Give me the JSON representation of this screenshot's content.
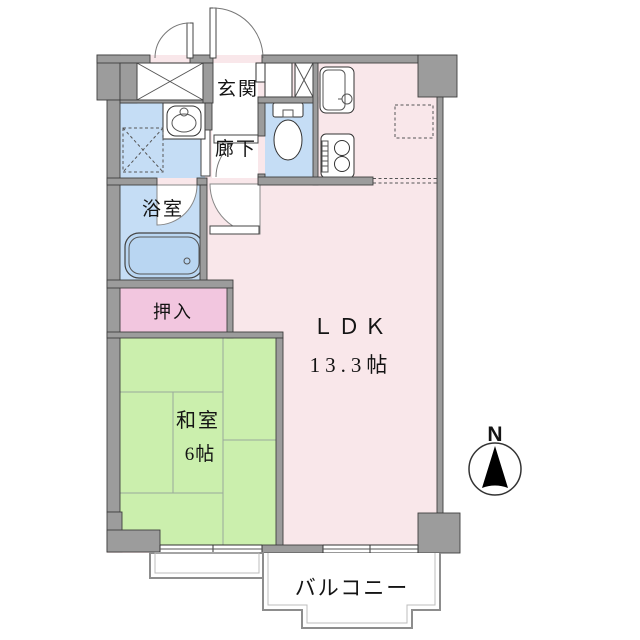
{
  "floor_plan": {
    "rooms": {
      "genkan": "玄関",
      "rouka": "廊下",
      "yokushitsu": "浴室",
      "oshiire": "押入",
      "washitsu_name": "和室",
      "washitsu_size": "6帖",
      "ldk_name": "ＬＤＫ",
      "ldk_size": "13.3帖",
      "balcony": "バルコニー"
    },
    "compass_north": "N",
    "colors": {
      "wall": "#9c9c9c",
      "water_room": "#c5ddf5",
      "bathtub": "#b9d6f2",
      "ldk_pink": "#f9e7ea",
      "oshiire_pink": "#f2c6df",
      "tatami_green": "#cbefad",
      "line": "#3f3f3f"
    }
  }
}
